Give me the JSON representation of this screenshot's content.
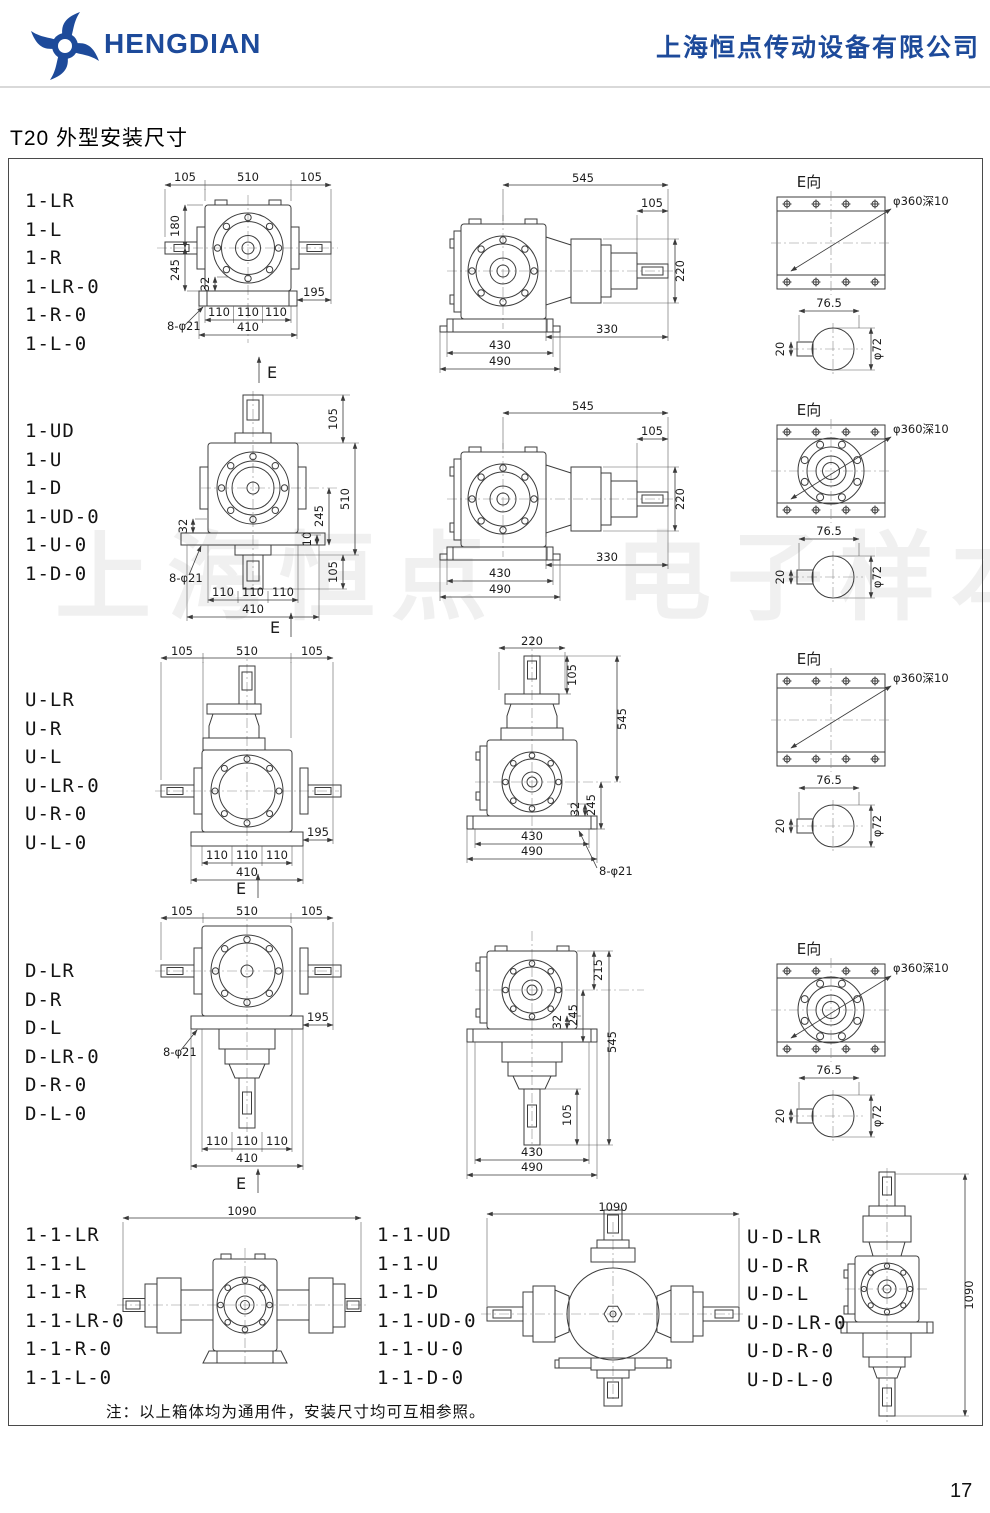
{
  "header": {
    "brand": "HENGDIAN",
    "company": "上海恒点传动设备有限公司"
  },
  "page": {
    "title": "T20 外型安装尺寸",
    "watermark": "上海恒点　电子样本",
    "note": "注：以上箱体均为通用件，安装尺寸均可互相参照。",
    "number": "17"
  },
  "rows": [
    {
      "labels": [
        "1-LR",
        "1-L",
        "1-R",
        "1-LR-0",
        "1-R-0",
        "1-L-0"
      ],
      "front": {
        "t1": "105",
        "t2": "510",
        "t3": "105",
        "l180": "180",
        "l245": "245",
        "s32": "32",
        "holes": "8-φ21",
        "b1": "110",
        "b2": "110",
        "b3": "110",
        "r195": "195",
        "b410": "410",
        "e": "E"
      },
      "side": {
        "t545": "545",
        "t105": "105",
        "r220": "220",
        "b330": "330",
        "b430": "430",
        "b490": "490"
      },
      "eview": {
        "title": "E向",
        "callout": "φ360深10",
        "w765": "76.5",
        "k20": "20",
        "d72": "φ72"
      }
    },
    {
      "labels": [
        "1-UD",
        "1-U",
        "1-D",
        "1-UD-0",
        "1-U-0",
        "1-D-0"
      ],
      "front": {
        "r105t": "105",
        "r510": "510",
        "r105b": "105",
        "l32": "32",
        "r10": "10",
        "r245": "245",
        "holes": "8-φ21",
        "b1": "110",
        "b2": "110",
        "b3": "110",
        "b410": "410",
        "e": "E"
      },
      "side": {
        "t545": "545",
        "t105": "105",
        "r220": "220",
        "b330": "330",
        "b430": "430",
        "b490": "490"
      },
      "eview": {
        "title": "E向",
        "callout": "φ360深10",
        "w765": "76.5",
        "k20": "20",
        "d72": "φ72"
      }
    },
    {
      "labels": [
        "U-LR",
        "U-R",
        "U-L",
        "U-LR-0",
        "U-R-0",
        "U-L-0"
      ],
      "front": {
        "t1": "105",
        "t2": "510",
        "t3": "105",
        "b1": "110",
        "b2": "110",
        "b3": "110",
        "r195": "195",
        "b410": "410",
        "e": "E"
      },
      "side": {
        "t220": "220",
        "r105": "105",
        "r545": "545",
        "r32": "32",
        "r245": "245",
        "b430": "430",
        "b490": "490",
        "holes": "8-φ21"
      },
      "eview": {
        "title": "E向",
        "callout": "φ360深10",
        "w765": "76.5",
        "k20": "20",
        "d72": "φ72"
      }
    },
    {
      "labels": [
        "D-LR",
        "D-R",
        "D-L",
        "D-LR-0",
        "D-R-0",
        "D-L-0"
      ],
      "front": {
        "t1": "105",
        "t2": "510",
        "t3": "105",
        "holes": "8-φ21",
        "r195": "195",
        "b1": "110",
        "b2": "110",
        "b3": "110",
        "b410": "410",
        "e": "E"
      },
      "side": {
        "r215": "215",
        "r32": "32",
        "r245": "245",
        "r545": "545",
        "r105": "105",
        "b430": "430",
        "b490": "490"
      },
      "eview": {
        "title": "E向",
        "callout": "φ360深10",
        "w765": "76.5",
        "k20": "20",
        "d72": "φ72"
      }
    }
  ],
  "bottom": {
    "groups": [
      {
        "labels": [
          "1-1-LR",
          "1-1-L",
          "1-1-R",
          "1-1-LR-0",
          "1-1-R-0",
          "1-1-L-0"
        ],
        "dim": "1090"
      },
      {
        "labels": [
          "1-1-UD",
          "1-1-U",
          "1-1-D",
          "1-1-UD-0",
          "1-1-U-0",
          "1-1-D-0"
        ],
        "dim": "1090"
      },
      {
        "labels": [
          "U-D-LR",
          "U-D-R",
          "U-D-L",
          "U-D-LR-0",
          "U-D-R-0",
          "U-D-L-0"
        ],
        "dim": "1090"
      }
    ]
  }
}
